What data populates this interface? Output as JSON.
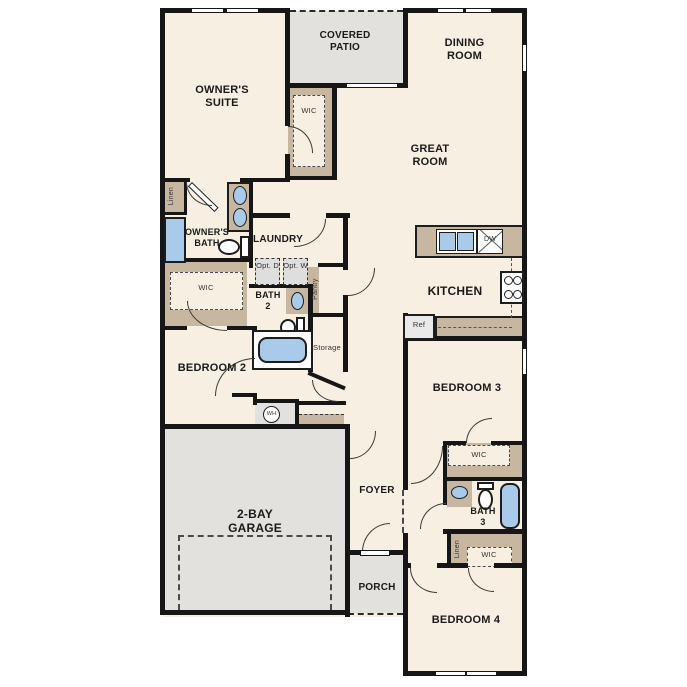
{
  "plan": {
    "title": "single-story home floor plan",
    "labels": {
      "covered_patio": "COVERED PATIO",
      "dining_room": "DINING ROOM",
      "owners_suite": "OWNER'S SUITE",
      "great_room": "GREAT ROOM",
      "wic_owner": "WIC",
      "linen_owner": "Linen",
      "owners_bath": "OWNER'S BATH",
      "laundry": "LAUNDRY",
      "opt_d": "Opt. D",
      "opt_w": "Opt. W",
      "wic_bed2": "WIC",
      "bath_2": "BATH 2",
      "pantry": "Pantry",
      "kitchen": "KITCHEN",
      "dw": "DW",
      "ref": "Ref",
      "storage": "Storage",
      "bedroom_2": "BEDROOM 2",
      "wh": "WH",
      "bedroom_3": "BEDROOM 3",
      "wic_bed3": "WIC",
      "bath_3": "BATH 3",
      "linen_hall": "Linen",
      "wic_bed4": "WIC",
      "garage": "2-BAY GARAGE",
      "foyer": "FOYER",
      "porch": "PORCH",
      "bedroom_4": "BEDROOM 4"
    }
  },
  "colors": {
    "floor": "#f7f0e2",
    "outdoor": "#e2e1de",
    "casework": "#c8b7a0",
    "fixture": "#a9cae8",
    "wall": "#161616",
    "optional_appliance": "#dedede"
  }
}
